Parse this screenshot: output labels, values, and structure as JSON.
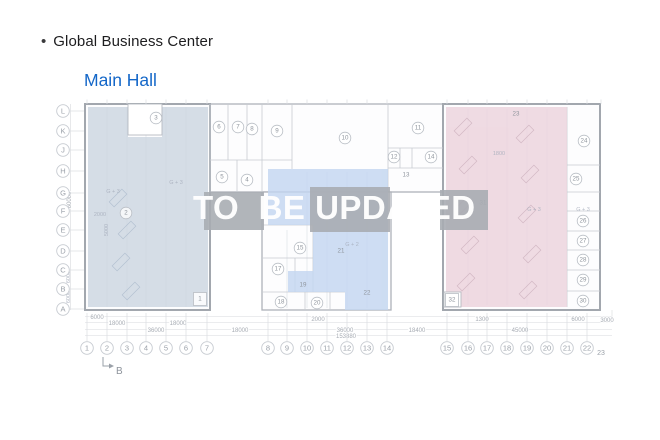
{
  "header": {
    "bullet": "•",
    "title": "Global Business Center",
    "subtitle": "Main Hall",
    "subtitle_color": "#1467c8"
  },
  "watermark": {
    "text": "TO  BE UPDATED",
    "color": "#ffffff"
  },
  "plan": {
    "colors": {
      "left_region": "#ccd5e0",
      "middle_region": "#c3d6f0",
      "right_region": "#ecd3dd",
      "watermark_chip": "#a9adb3",
      "outer_wall": "#a2a7ae",
      "partition": "#c7cbd1",
      "faint_line": "#dadde1",
      "label_text": "#9ba1a9"
    },
    "section_marker": "B",
    "grid_rows": [
      {
        "label": "L",
        "y": 111
      },
      {
        "label": "K",
        "y": 131
      },
      {
        "label": "J",
        "y": 150
      },
      {
        "label": "H",
        "y": 171
      },
      {
        "label": "G",
        "y": 193
      },
      {
        "label": "F",
        "y": 211
      },
      {
        "label": "E",
        "y": 230
      },
      {
        "label": "D",
        "y": 251
      },
      {
        "label": "C",
        "y": 270
      },
      {
        "label": "B",
        "y": 289
      },
      {
        "label": "A",
        "y": 309
      }
    ],
    "grid_columns": [
      {
        "label": "1",
        "x": 87
      },
      {
        "label": "2",
        "x": 107
      },
      {
        "label": "3",
        "x": 127
      },
      {
        "label": "4",
        "x": 146
      },
      {
        "label": "5",
        "x": 166
      },
      {
        "label": "6",
        "x": 186
      },
      {
        "label": "7",
        "x": 207
      },
      {
        "label": "8",
        "x": 268
      },
      {
        "label": "9",
        "x": 287
      },
      {
        "label": "10",
        "x": 307
      },
      {
        "label": "11",
        "x": 327
      },
      {
        "label": "12",
        "x": 347
      },
      {
        "label": "13",
        "x": 367
      },
      {
        "label": "14",
        "x": 387
      },
      {
        "label": "15",
        "x": 447
      },
      {
        "label": "16",
        "x": 468
      },
      {
        "label": "17",
        "x": 487
      },
      {
        "label": "18",
        "x": 507
      },
      {
        "label": "19",
        "x": 527
      },
      {
        "label": "20",
        "x": 547
      },
      {
        "label": "21",
        "x": 567
      },
      {
        "label": "22",
        "x": 587
      },
      {
        "label": "23",
        "x": 601,
        "small": true
      }
    ],
    "rooms": [
      {
        "label": "1",
        "x": 200,
        "y": 299,
        "shape": "square"
      },
      {
        "label": "2",
        "x": 126,
        "y": 213,
        "shape": "circle"
      },
      {
        "label": "3",
        "x": 156,
        "y": 118,
        "shape": "circle"
      },
      {
        "label": "4",
        "x": 247,
        "y": 180,
        "shape": "circle"
      },
      {
        "label": "5",
        "x": 222,
        "y": 177,
        "shape": "circle"
      },
      {
        "label": "6",
        "x": 219,
        "y": 127,
        "shape": "circle"
      },
      {
        "label": "7",
        "x": 238,
        "y": 127,
        "shape": "circle"
      },
      {
        "label": "8",
        "x": 252,
        "y": 129,
        "shape": "circle"
      },
      {
        "label": "9",
        "x": 277,
        "y": 131,
        "shape": "circle"
      },
      {
        "label": "10",
        "x": 345,
        "y": 138,
        "shape": "circle"
      },
      {
        "label": "11",
        "x": 418,
        "y": 128,
        "shape": "circle"
      },
      {
        "label": "12",
        "x": 394,
        "y": 157,
        "shape": "circle"
      },
      {
        "label": "13",
        "x": 406,
        "y": 175,
        "shape": "plain"
      },
      {
        "label": "14",
        "x": 431,
        "y": 157,
        "shape": "circle"
      },
      {
        "label": "15",
        "x": 300,
        "y": 248,
        "shape": "circle"
      },
      {
        "label": "17",
        "x": 278,
        "y": 269,
        "shape": "circle"
      },
      {
        "label": "18",
        "x": 281,
        "y": 302,
        "shape": "circle"
      },
      {
        "label": "19",
        "x": 303,
        "y": 285,
        "shape": "plain"
      },
      {
        "label": "20",
        "x": 317,
        "y": 303,
        "shape": "circle"
      },
      {
        "label": "21",
        "x": 341,
        "y": 251,
        "shape": "plain"
      },
      {
        "label": "22",
        "x": 367,
        "y": 293,
        "shape": "plain"
      },
      {
        "label": "23",
        "x": 516,
        "y": 114,
        "shape": "plain"
      },
      {
        "label": "24",
        "x": 584,
        "y": 141,
        "shape": "circle"
      },
      {
        "label": "25",
        "x": 576,
        "y": 179,
        "shape": "circle"
      },
      {
        "label": "26",
        "x": 583,
        "y": 221,
        "shape": "circle"
      },
      {
        "label": "27",
        "x": 583,
        "y": 241,
        "shape": "circle"
      },
      {
        "label": "28",
        "x": 583,
        "y": 260,
        "shape": "circle"
      },
      {
        "label": "29",
        "x": 583,
        "y": 280,
        "shape": "circle"
      },
      {
        "label": "30",
        "x": 583,
        "y": 301,
        "shape": "circle"
      },
      {
        "label": "31",
        "x": 483,
        "y": 203,
        "shape": "plain"
      },
      {
        "label": "32",
        "x": 452,
        "y": 300,
        "shape": "square"
      }
    ],
    "dimensions": [
      {
        "text": "6000",
        "x": 97,
        "y": 319
      },
      {
        "text": "2000",
        "x": 318,
        "y": 321
      },
      {
        "text": "1300",
        "x": 482,
        "y": 321
      },
      {
        "text": "6000",
        "x": 578,
        "y": 321
      },
      {
        "text": "3000",
        "x": 607,
        "y": 322
      },
      {
        "text": "18000",
        "x": 117,
        "y": 325
      },
      {
        "text": "18000",
        "x": 178,
        "y": 325
      },
      {
        "text": "36000",
        "x": 156,
        "y": 332
      },
      {
        "text": "18000",
        "x": 240,
        "y": 332
      },
      {
        "text": "36000",
        "x": 345,
        "y": 332
      },
      {
        "text": "18400",
        "x": 417,
        "y": 332
      },
      {
        "text": "45000",
        "x": 520,
        "y": 332
      },
      {
        "text": "153880",
        "x": 346,
        "y": 338
      },
      {
        "text": "60000",
        "x": 71,
        "y": 200,
        "vertical": true
      }
    ],
    "annotations": [
      {
        "text": "G + 3",
        "x": 113,
        "y": 193
      },
      {
        "text": "G + 3",
        "x": 176,
        "y": 184
      },
      {
        "text": "2000",
        "x": 100,
        "y": 216
      },
      {
        "text": "5000",
        "x": 108,
        "y": 230,
        "vertical": true
      },
      {
        "text": "G + 2",
        "x": 352,
        "y": 246
      },
      {
        "text": "G + 3",
        "x": 534,
        "y": 211
      },
      {
        "text": "G + 3",
        "x": 583,
        "y": 211
      },
      {
        "text": "1800",
        "x": 499,
        "y": 155
      },
      {
        "text": "6000",
        "x": 70,
        "y": 277,
        "vertical": true
      },
      {
        "text": "6000",
        "x": 70,
        "y": 297,
        "vertical": true
      }
    ]
  }
}
